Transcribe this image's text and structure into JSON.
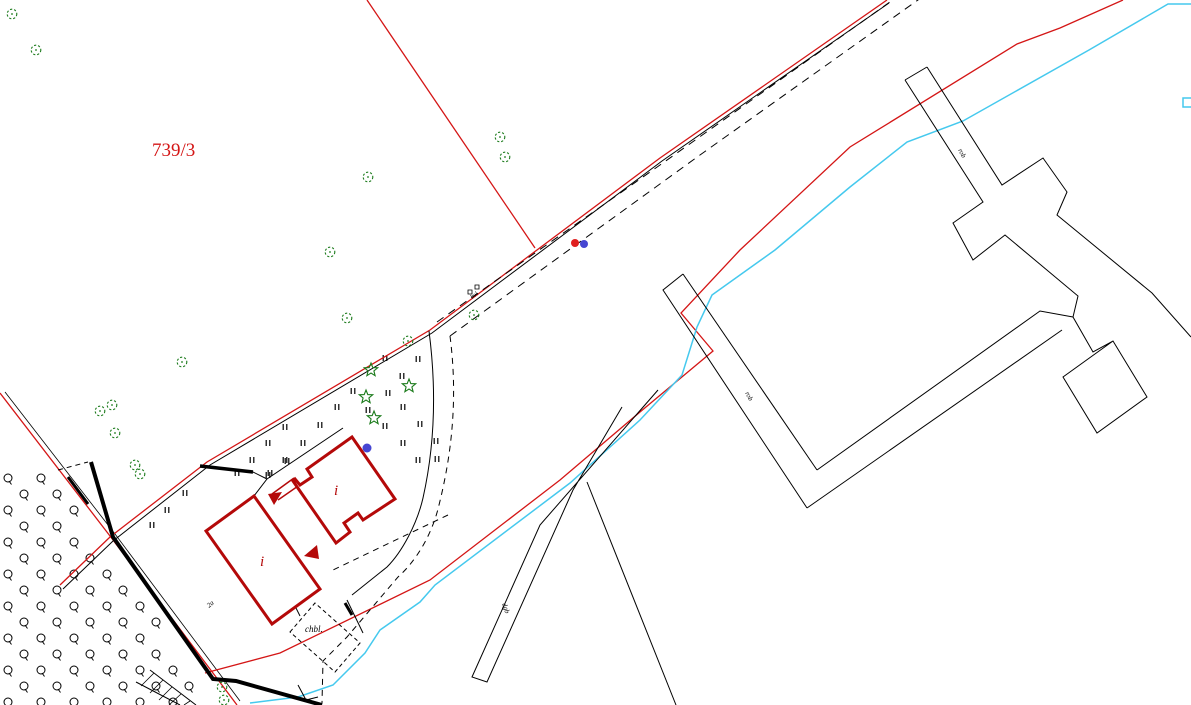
{
  "map_title": "cadastral-survey-map",
  "canvas": {
    "width": 1191,
    "height": 705,
    "background": "#ffffff"
  },
  "colors": {
    "red": "#d41616",
    "building_red": "#b40909",
    "black": "#000000",
    "green": "#1a7a1a",
    "cyan": "#45c9ee",
    "blue_dot": "#4646d2",
    "red_dot": "#e02020"
  },
  "labels": [
    {
      "name": "parcel-number",
      "text": "739/3",
      "x": 152,
      "y": 156,
      "size": 19,
      "color": "red",
      "rot": 0,
      "italic": false
    },
    {
      "name": "building-label-i-upper",
      "text": "i",
      "x": 334,
      "y": 495,
      "size": 15,
      "color": "building_red",
      "rot": 0,
      "italic": true
    },
    {
      "name": "building-label-i-lower",
      "text": "i",
      "x": 260,
      "y": 566,
      "size": 15,
      "color": "building_red",
      "rot": 0,
      "italic": true
    },
    {
      "name": "shed-label",
      "text": "chbl.",
      "x": 305,
      "y": 632,
      "size": 9,
      "color": "black",
      "rot": 0,
      "italic": true
    },
    {
      "name": "strip-label-rob-top",
      "text": "rob",
      "x": 958,
      "y": 150,
      "size": 7,
      "color": "black",
      "rot": 62,
      "italic": true
    },
    {
      "name": "strip-label-rob-mid",
      "text": "rob",
      "x": 745,
      "y": 393,
      "size": 7,
      "color": "black",
      "rot": 62,
      "italic": true
    },
    {
      "name": "sliver-label-dgb",
      "text": "dgb",
      "x": 502,
      "y": 604,
      "size": 7,
      "color": "black",
      "rot": 70,
      "italic": true
    },
    {
      "name": "track-label-bol",
      "text": "bol",
      "x": 472,
      "y": 299,
      "size": 6,
      "color": "black",
      "rot": -36,
      "italic": true
    },
    {
      "name": "yard-label-2a",
      "text": "2a",
      "x": 209,
      "y": 608,
      "size": 7,
      "color": "black",
      "rot": -40,
      "italic": true
    }
  ],
  "paths": [
    {
      "name": "left-boundary-red",
      "d": "M0,393 L110,536 L237,705",
      "color": "red",
      "w": 1.3
    },
    {
      "name": "left-boundary-fence-black",
      "d": "M5,392 L115,534 L240,701",
      "color": "black",
      "w": 0.8
    },
    {
      "name": "road-boundary-red",
      "d": "M60,585 L110,537 L207,462 L430,330 L660,158 L887,0",
      "color": "red",
      "w": 1.3
    },
    {
      "name": "road-boundary-black",
      "d": "M63,589 L113,541 L210,465 L432,333 L662,161 L889,3",
      "color": "black",
      "w": 1
    },
    {
      "name": "parcel-split-red",
      "d": "M367,0 L535,248",
      "color": "red",
      "w": 1.3
    },
    {
      "name": "stream-red-zigzag",
      "d": "M1123,0 L1060,28 L1017,44 L850,147 L740,250 L681,313 L713,351 L640,412 L560,480 L430,580 L280,653 L205,673",
      "color": "red",
      "w": 1.3
    },
    {
      "name": "stream-cyan",
      "d": "M1191,4 L1168,4 L1089,50 L963,121 L907,142 L850,187 L775,250 L712,295 L697,327 L682,375 L640,420 L570,483 L435,585 L420,602 L380,630 L365,653 L333,685 L298,697 L250,703",
      "color": "cyan",
      "w": 1.5
    },
    {
      "name": "culvert-cyan-bracket",
      "d": "M1191,98 L1183,98 L1183,107 L1191,107",
      "color": "cyan",
      "w": 1.5
    },
    {
      "name": "track-dashed-inner",
      "d": "M437,322 L660,165 L897,-3",
      "color": "black",
      "w": 1,
      "dash": "8,6"
    },
    {
      "name": "track-dashed-outer",
      "d": "M450,336 L700,155 L925,-5",
      "color": "black",
      "w": 1,
      "dash": "8,6"
    },
    {
      "name": "scrub-edge-solid",
      "d": "M429,331 C436,385 436,440 423,498 C417,524 402,552 387,567 L352,595",
      "color": "black",
      "w": 1
    },
    {
      "name": "scrub-edge-dashed",
      "d": "M450,336 C457,390 454,445 439,505 C432,535 416,561 398,577 L347,637 L323,661 L322,703",
      "color": "black",
      "w": 1,
      "dash": "6,5"
    },
    {
      "name": "yard-dashed-diagonal",
      "d": "M448,515 L333,570",
      "color": "black",
      "w": 1,
      "dash": "6,5"
    },
    {
      "name": "shed-dashed-outline",
      "d": "M290,632 L315,603 L360,643 L335,672 Z",
      "color": "black",
      "w": 1,
      "dash": "4,3"
    },
    {
      "name": "gate-dashes",
      "d": "M58,470 L88,462",
      "color": "black",
      "w": 1,
      "dash": "5,4"
    },
    {
      "name": "wall-thick-west",
      "d": "M91,462 L113,537 L213,679 L236,681 L322,705",
      "color": "black",
      "w": 4
    },
    {
      "name": "wall-thick-short",
      "d": "M68,477 L88,504",
      "color": "black",
      "w": 3
    },
    {
      "name": "wall-thick-north",
      "d": "M200,466 L253,472",
      "color": "black",
      "w": 3.5
    },
    {
      "name": "wall-bit-shed",
      "d": "M345,603 L352,615",
      "color": "black",
      "w": 3
    },
    {
      "name": "yard-outline-nw",
      "d": "M343,428 L267,479 L254,496",
      "color": "black",
      "w": 1
    },
    {
      "name": "yard-outline-link",
      "d": "M253,472 L267,479",
      "color": "black",
      "w": 1
    },
    {
      "name": "yard-bit-1",
      "d": "M292,600 L300,616",
      "color": "black",
      "w": 1
    },
    {
      "name": "yard-bit-2",
      "d": "M347,600 L363,633",
      "color": "black",
      "w": 1
    },
    {
      "name": "yard-bit-3",
      "d": "M298,685 L306,700 L318,697",
      "color": "black",
      "w": 1
    },
    {
      "name": "sliver-triangle",
      "d": "M658,390 L540,525 L472,677 L487,682 L573,490 L622,407",
      "color": "black",
      "w": 1
    },
    {
      "name": "ditch-line-south",
      "d": "M587,482 L676,705",
      "color": "black",
      "w": 1
    },
    {
      "name": "strip-north-cap",
      "d": "M905,80 L927,67",
      "color": "black",
      "w": 1
    },
    {
      "name": "strip-network-west",
      "d": "M905,80 L983,202 L953,223 L973,260 L1005,235 L1078,296 L1073,317 L1093,352 L1113,341 L1147,397 L1097,433 L1063,377 L1113,341",
      "color": "black",
      "w": 1
    },
    {
      "name": "strip-network-east",
      "d": "M927,67 L1002,185 L1043,158 L1067,192 L1057,215 L1152,293 L1191,337",
      "color": "black",
      "w": 1
    },
    {
      "name": "field-edge-a",
      "d": "M817,470 L1040,311 L1073,317",
      "color": "black",
      "w": 1
    },
    {
      "name": "field-edge-b",
      "d": "M807,508 L1062,330",
      "color": "black",
      "w": 1
    },
    {
      "name": "strip-mid-west",
      "d": "M683,274 L663,290 L807,508",
      "color": "black",
      "w": 1
    },
    {
      "name": "strip-mid-east",
      "d": "M683,274 L817,470",
      "color": "black",
      "w": 1
    },
    {
      "name": "ramp-rail-1",
      "d": "M150,670 L196,705",
      "color": "black",
      "w": 1
    },
    {
      "name": "ramp-rail-2",
      "d": "M136,682 L180,705",
      "color": "black",
      "w": 1
    },
    {
      "name": "ramp-rung-1",
      "d": "M154,673 L141,686",
      "color": "black",
      "w": 0.8
    },
    {
      "name": "ramp-rung-2",
      "d": "M163,680 L150,693",
      "color": "black",
      "w": 0.8
    },
    {
      "name": "ramp-rung-3",
      "d": "M172,687 L159,700",
      "color": "black",
      "w": 0.8
    },
    {
      "name": "ramp-rung-4",
      "d": "M181,694 L169,705",
      "color": "black",
      "w": 0.8
    },
    {
      "name": "ramp-rung-5",
      "d": "M190,701 L184,705",
      "color": "black",
      "w": 0.8
    },
    {
      "name": "gate-symbol-boxes",
      "d": "M468,290 h4 v4 h-4 Z M475,285 h4 v4 h-4 Z",
      "color": "black",
      "w": 0.8
    },
    {
      "name": "connector-red-1",
      "d": "M301,484 L278,500",
      "color": "building_red",
      "w": 1.5
    },
    {
      "name": "connector-red-2",
      "d": "M294,478 L272,494",
      "color": "building_red",
      "w": 1.5
    }
  ],
  "buildings": [
    {
      "name": "building-upper",
      "d": "M352,437 L395,499 L363,520 L358,513 L344,523 L350,532 L336,543 L293,481 L295,479 L300,485 L312,477 L307,469 Z",
      "color": "building_red",
      "w": 3
    },
    {
      "name": "building-lower",
      "d": "M254,496 L320,589 L272,624 L206,531 Z",
      "color": "building_red",
      "w": 3
    }
  ],
  "arrows": [
    {
      "name": "red-arrow-connector",
      "points": "268,494 282,492 274,505",
      "color": "building_red"
    },
    {
      "name": "red-arrow-door",
      "points": "304,556 317,545 319,559",
      "color": "building_red"
    }
  ],
  "dots": [
    {
      "name": "survey-dot-red",
      "x": 575,
      "y": 243,
      "r": 4,
      "color": "red_dot"
    },
    {
      "name": "survey-dot-blue-road",
      "x": 584,
      "y": 244,
      "r": 4,
      "color": "blue_dot"
    },
    {
      "name": "survey-dot-blue-building",
      "x": 367,
      "y": 448,
      "r": 4.5,
      "color": "blue_dot"
    }
  ],
  "trees_deciduous": [
    [
      12,
      14
    ],
    [
      36,
      50
    ],
    [
      500,
      137
    ],
    [
      505,
      157
    ],
    [
      368,
      177
    ],
    [
      330,
      252
    ],
    [
      347,
      318
    ],
    [
      474,
      315
    ],
    [
      408,
      341
    ],
    [
      182,
      362
    ],
    [
      100,
      411
    ],
    [
      112,
      405
    ],
    [
      115,
      433
    ],
    [
      135,
      465
    ],
    [
      140,
      474
    ],
    [
      222,
      687
    ],
    [
      224,
      700
    ]
  ],
  "trees_conifer": [
    [
      371,
      370
    ],
    [
      409,
      386
    ],
    [
      366,
      397
    ],
    [
      374,
      418
    ]
  ],
  "grass_marks": [
    [
      268,
      443
    ],
    [
      303,
      443
    ],
    [
      252,
      460
    ],
    [
      287,
      461
    ],
    [
      237,
      473
    ],
    [
      270,
      473
    ],
    [
      403,
      443
    ],
    [
      418,
      460
    ],
    [
      436,
      441
    ],
    [
      385,
      358
    ],
    [
      418,
      359
    ],
    [
      402,
      376
    ],
    [
      353,
      391
    ],
    [
      388,
      393
    ],
    [
      337,
      407
    ],
    [
      368,
      410
    ],
    [
      403,
      407
    ],
    [
      320,
      425
    ],
    [
      385,
      426
    ],
    [
      285,
      427
    ],
    [
      420,
      424
    ],
    [
      437,
      459
    ],
    [
      268,
      475
    ],
    [
      318,
      479
    ],
    [
      185,
      493
    ],
    [
      167,
      510
    ],
    [
      152,
      525
    ],
    [
      285,
      460
    ]
  ],
  "orchard_pattern": {
    "comment": "fruit-tree circle grid, lower-left field",
    "y_start": 478,
    "y_end": 703,
    "y_step": 16,
    "x_even": 8,
    "x_odd": 24,
    "x_step": 33,
    "slope": 0.72,
    "y0": 390,
    "margin": 10,
    "x_max": 205,
    "radius": 4
  }
}
